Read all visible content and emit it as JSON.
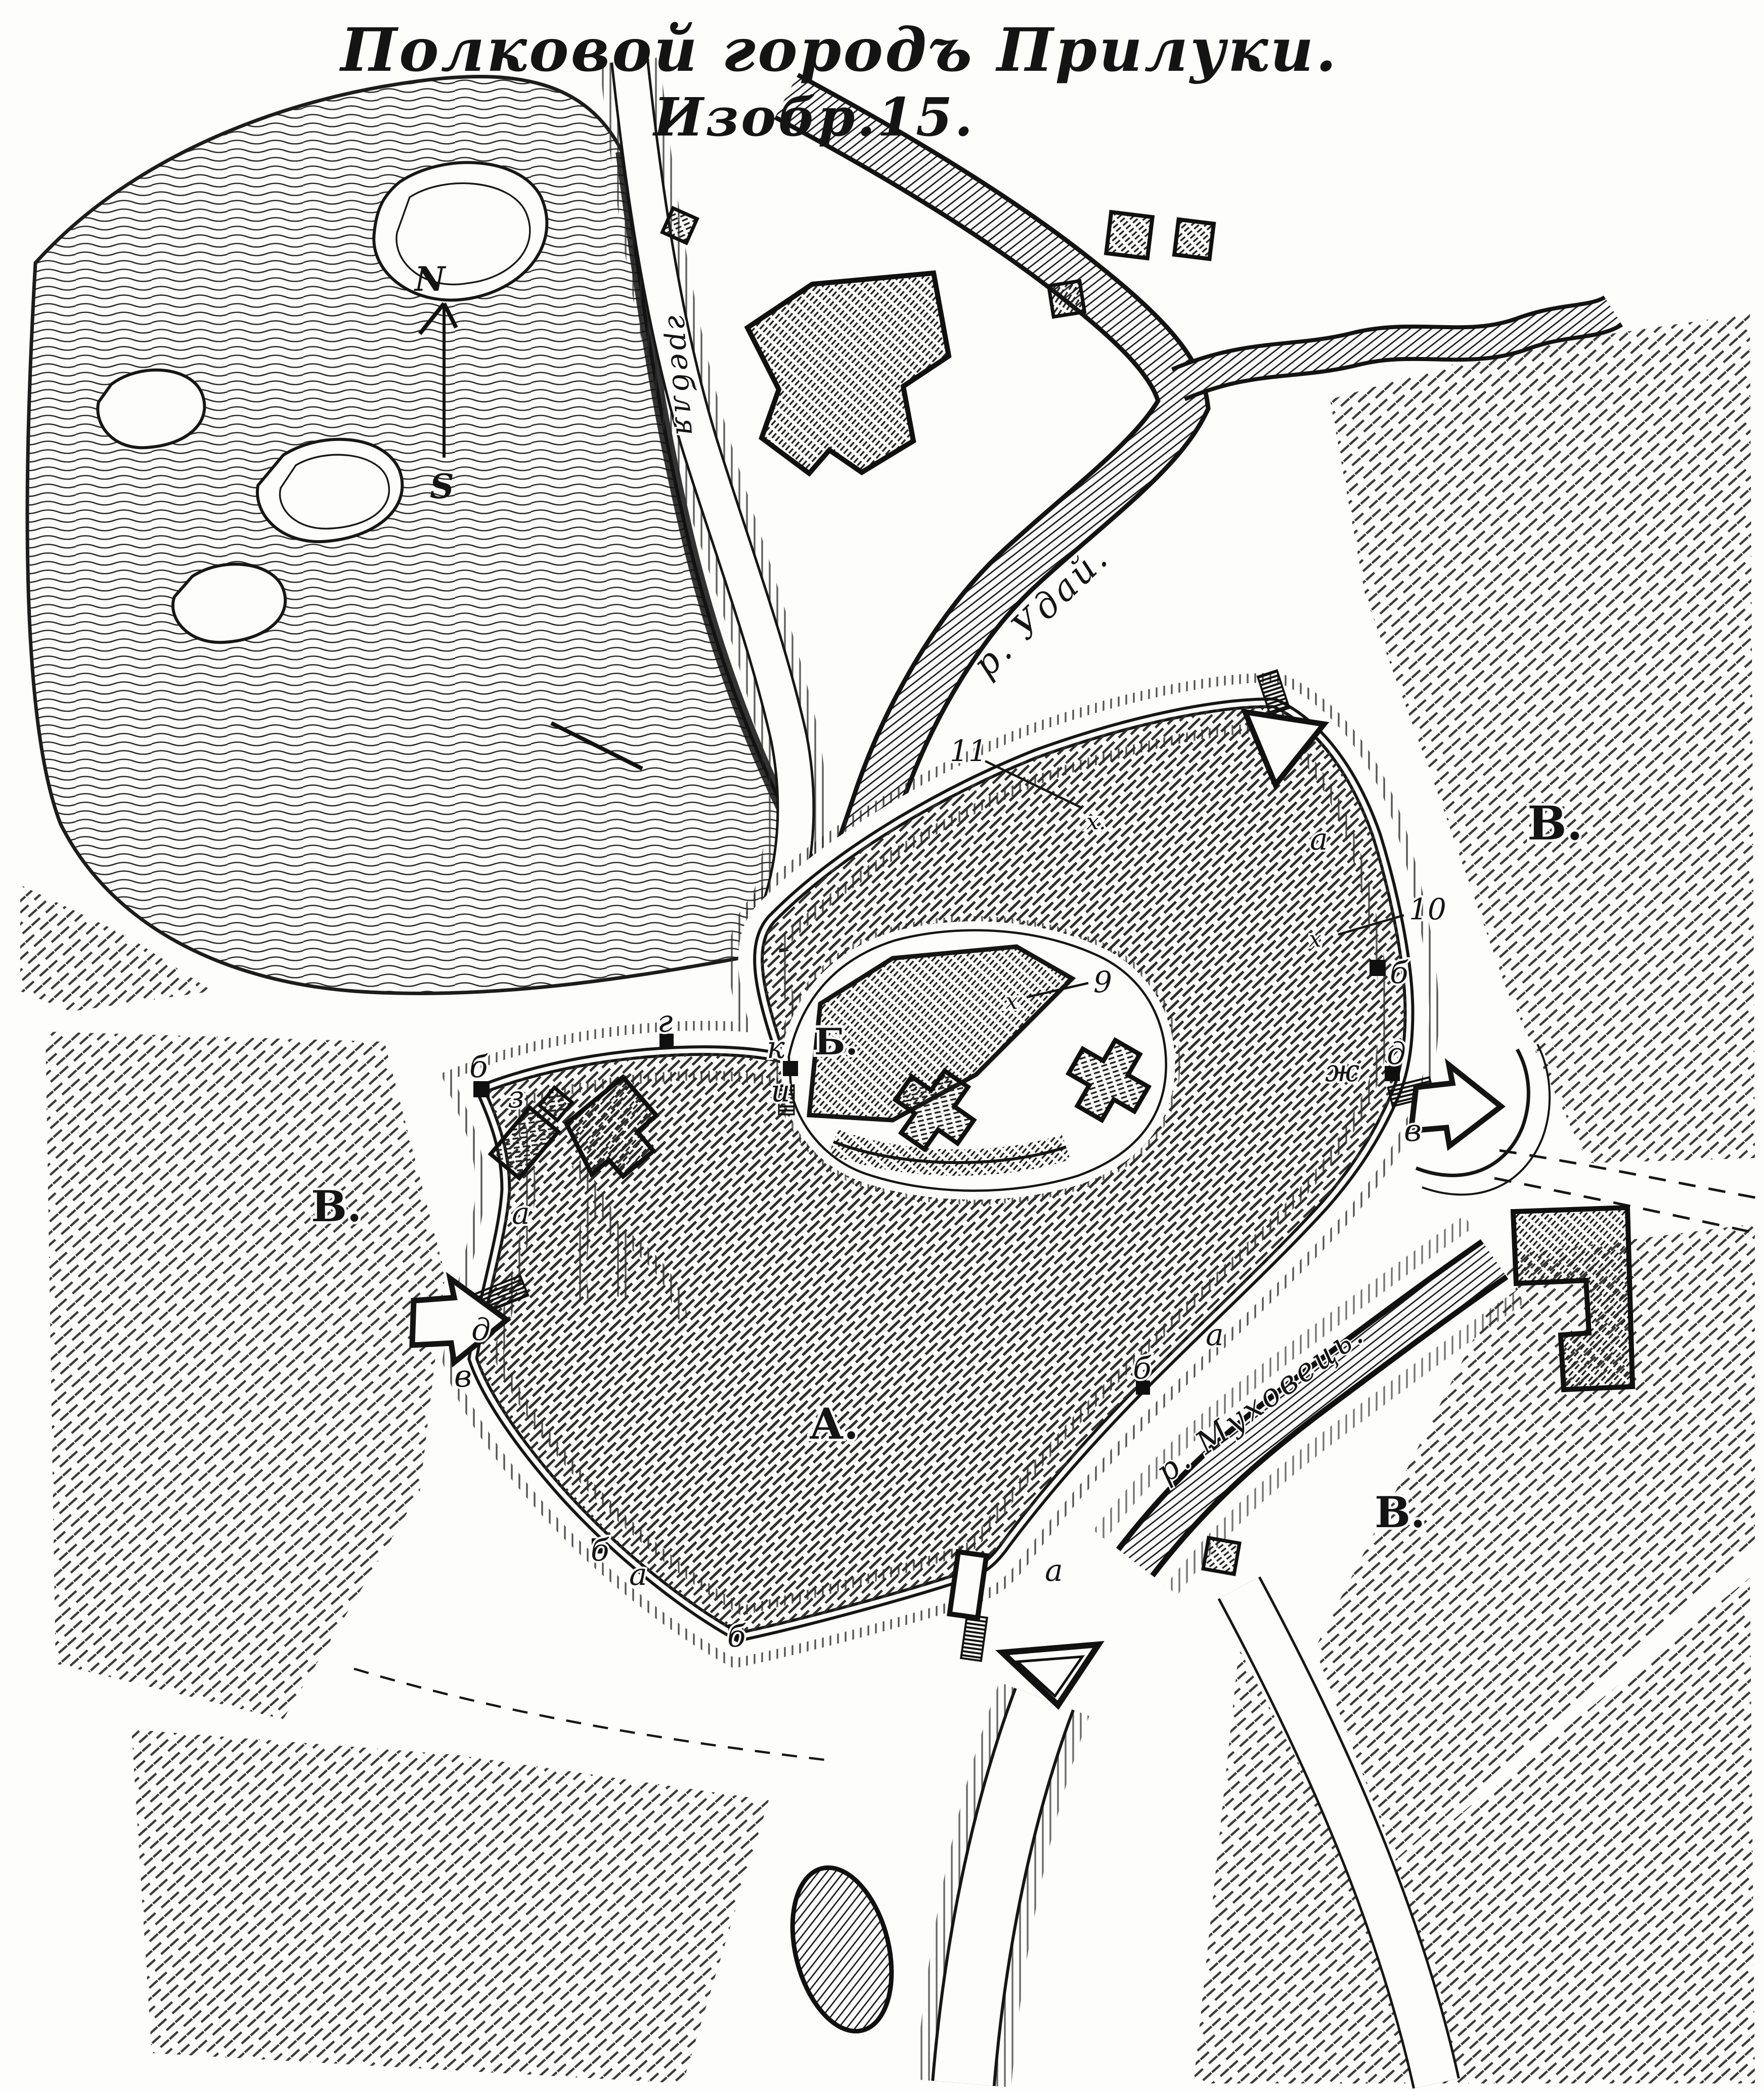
{
  "title": {
    "line1": "Полковой городъ Прилуки.",
    "line2": "Изобр.15."
  },
  "compass": {
    "north": "N",
    "south": "S"
  },
  "area_labels": {
    "town": "А.",
    "citadel": "Б.",
    "environs": "В."
  },
  "water_labels": {
    "uday": "р. Удай.",
    "mukhovets": "р. Муховець.",
    "greblya": "гребля"
  },
  "section_lines": {
    "s9": {
      "number": "9",
      "mark": "х"
    },
    "s10": {
      "number": "10",
      "mark": "х"
    },
    "s11": {
      "number": "11",
      "mark": "х."
    }
  },
  "letter_marks": {
    "a": "а",
    "b": "б",
    "v": "в",
    "g": "г",
    "d": "д",
    "zh": "ж",
    "z": "з",
    "i": "и",
    "k": "к"
  },
  "colors": {
    "ink": "#141414",
    "paper": "#fdfdfb"
  }
}
